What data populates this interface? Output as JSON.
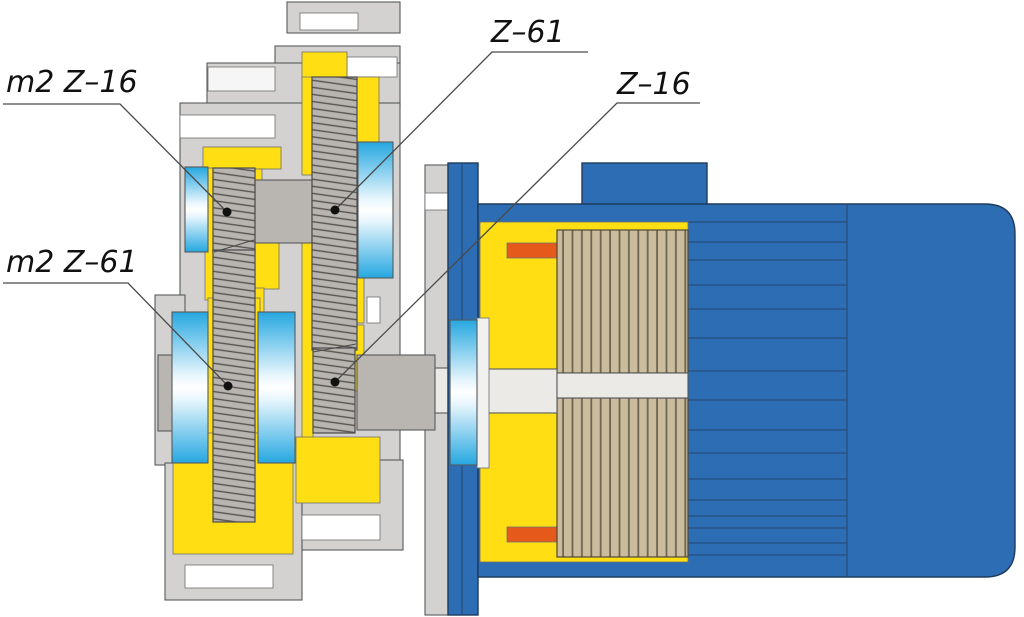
{
  "diagram": {
    "type": "cross-section engineering drawing",
    "subject": "two-stage gear reducer coupled to electric motor",
    "callouts": [
      {
        "text": "m2 Z–16"
      },
      {
        "text": "m2 Z–61"
      },
      {
        "text": "Z–61"
      },
      {
        "text": "Z–16"
      }
    ]
  },
  "colors": {
    "housing_gray": "#d3d2d0",
    "oil_yellow": "#ffdf14",
    "motor_blue": "#2d6db4",
    "bearing_cyan": "#25a7e0",
    "rotor_tan": "#cabc9c",
    "winding_orange": "#e5591b",
    "steel_gray": "#b9b6b2",
    "shaft_light": "#eceae7",
    "slot_white": "#ffffff",
    "outline": "#58595b",
    "label_black": "#111111"
  }
}
